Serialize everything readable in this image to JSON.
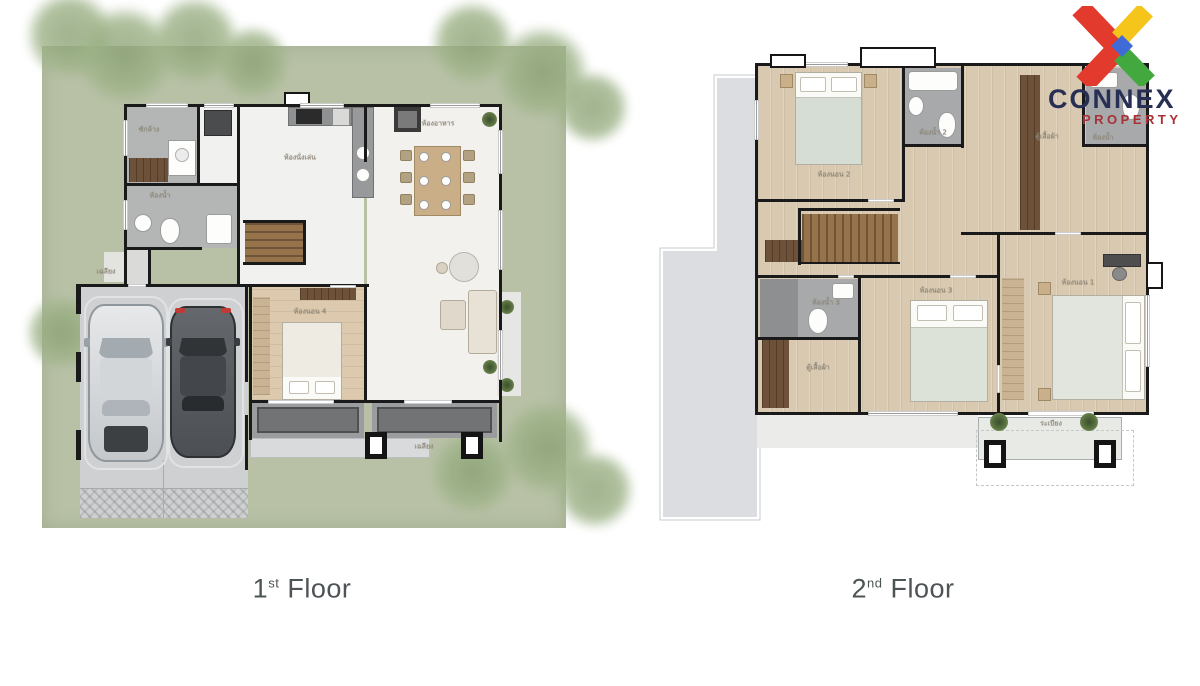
{
  "image_type": "real-estate two-storey house floor plan graphic",
  "logo": {
    "brand": "CONNEX",
    "subtitle": "PROPERTY",
    "mark": "x-ribbon-logo",
    "colors": {
      "ribbon_red": "#e23a2c",
      "ribbon_yellow": "#f5c51b",
      "ribbon_blue": "#3f6bd6",
      "ribbon_green": "#43a93f",
      "brand_text": "#273054",
      "subtitle_text": "#a93136"
    }
  },
  "captions": {
    "floor1": {
      "number": "1",
      "ordinal": "st",
      "word": "Floor"
    },
    "floor2": {
      "number": "2",
      "ordinal": "nd",
      "word": "Floor"
    },
    "text_color": "#4d5456"
  },
  "floor1": {
    "lot_color": "#b8c1a6",
    "rooms": [
      {
        "label": "ซักล้าง"
      },
      {
        "label": "ห้องน้ำ"
      },
      {
        "label": "ห้องนั่งเล่น"
      },
      {
        "label": "ห้องอาหาร"
      },
      {
        "label": "ห้องนอน 4"
      },
      {
        "label": "เฉลียง"
      },
      {
        "label": "เฉลียง"
      }
    ],
    "furniture": [
      "silver-car",
      "dark-car",
      "washer",
      "toilet",
      "sink",
      "kitchen-counter",
      "stove",
      "dining-table-6-seats",
      "staircase",
      "double-bed",
      "wardrobe",
      "sofa",
      "armchair",
      "plants",
      "terrace-columns"
    ]
  },
  "floor2": {
    "roof_color": "#dbdde0",
    "rooms": [
      {
        "label": "ห้องนอน 2"
      },
      {
        "label": "ห้องน้ำ 2"
      },
      {
        "label": "ตู้เสื้อผ้า"
      },
      {
        "label": "ห้องน้ำ"
      },
      {
        "label": "ห้องน้ำ 3"
      },
      {
        "label": "ห้องนอน 3"
      },
      {
        "label": "ตู้เสื้อผ้า"
      },
      {
        "label": "ห้องนอน 1"
      },
      {
        "label": "ระเบียง"
      }
    ],
    "furniture": [
      "double-bed-2",
      "double-bed-3",
      "double-bed-1",
      "bathtub",
      "toilet",
      "sink",
      "staircase",
      "wardrobes",
      "desk",
      "balcony-plants",
      "balcony-columns"
    ]
  }
}
